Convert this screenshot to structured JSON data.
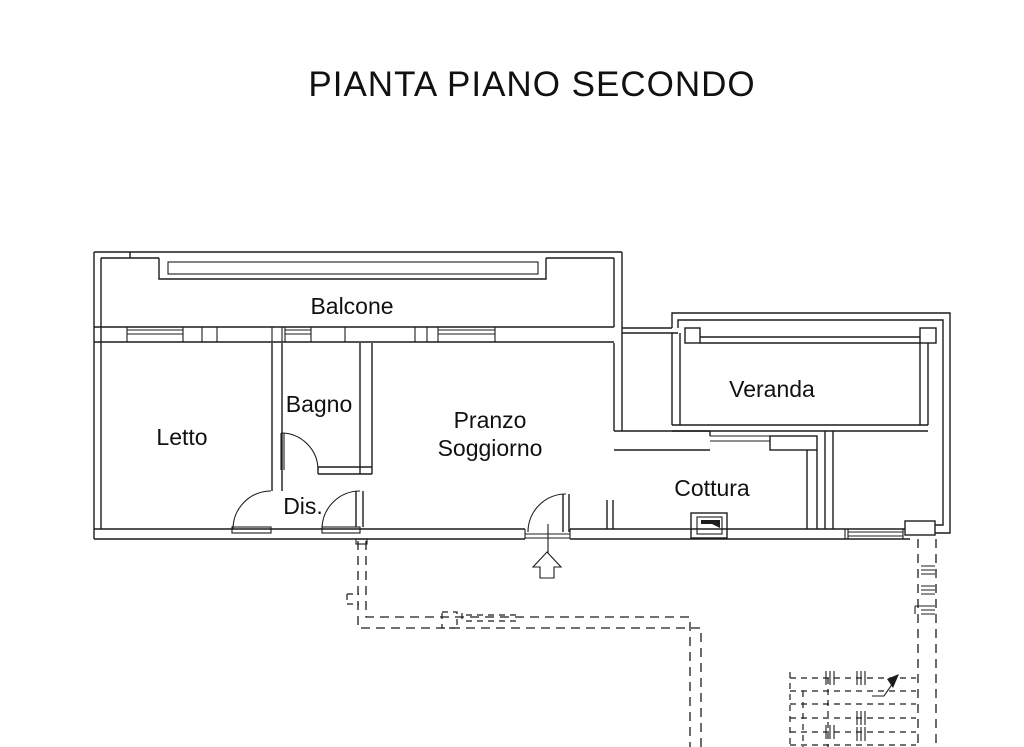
{
  "title": "PIANTA PIANO SECONDO",
  "plan": {
    "rooms": {
      "balcone": "Balcone",
      "letto": "Letto",
      "bagno": "Bagno",
      "dis": "Dis.",
      "pranzo_line1": "Pranzo",
      "pranzo_line2": "Soggiorno",
      "veranda": "Veranda",
      "cottura": "Cottura"
    },
    "symbols": {
      "entrance_arrow": "entrance-direction-arrow",
      "stairs_arrow": "stairs-direction-arrow",
      "appliance": "kitchen-appliance-box",
      "door_arcs": "door-swing-arc",
      "dashed_outline": "lower-floor-dashed-outline",
      "stairs": "stairs-below-dashed"
    },
    "colors": {
      "line": "#1c1c1c",
      "background": "#ffffff"
    }
  }
}
